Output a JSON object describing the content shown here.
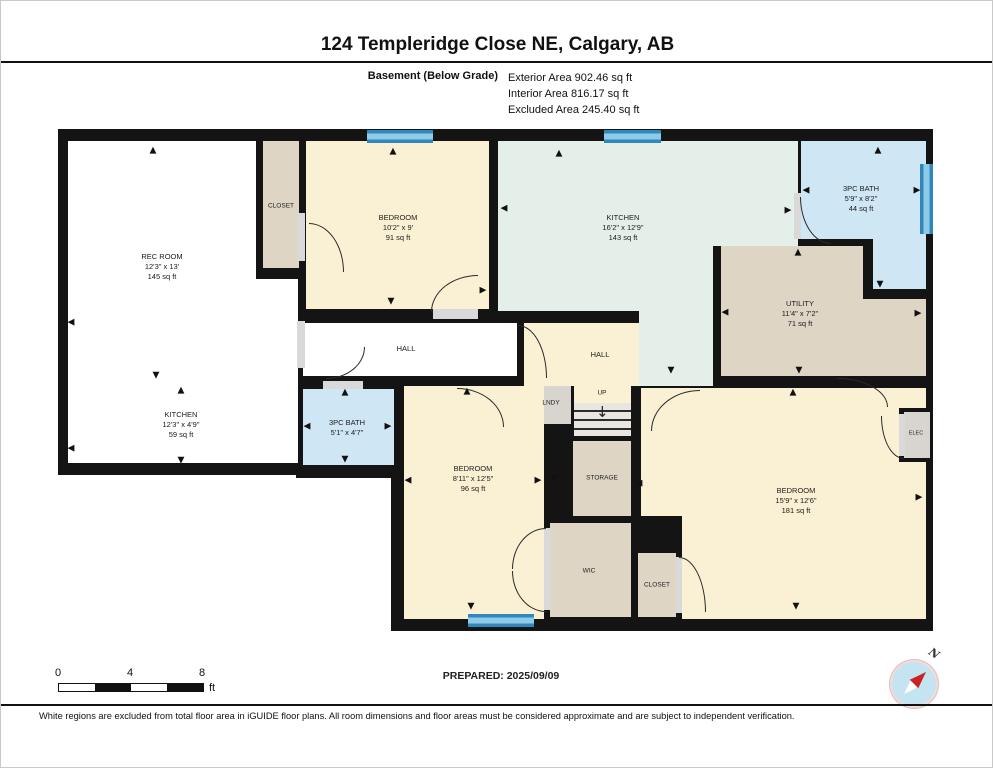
{
  "header": {
    "title": "124 Templeridge Close NE, Calgary, AB",
    "floor_label": "Basement (Below Grade)",
    "areas": {
      "exterior": "Exterior Area 902.46 sq ft",
      "interior": "Interior Area 816.17 sq ft",
      "excluded": "Excluded Area 245.40 sq ft"
    }
  },
  "rooms": {
    "rec_room": {
      "name": "REC ROOM",
      "dims": "12'3\" x 13'",
      "area": "145 sq ft"
    },
    "rec_kitchen": {
      "name": "KITCHEN",
      "dims": "12'3\" x 4'9\"",
      "area": "59 sq ft"
    },
    "closet_top": {
      "name": "CLOSET"
    },
    "bedroom_top": {
      "name": "BEDROOM",
      "dims": "10'2\" x 9'",
      "area": "91 sq ft"
    },
    "kitchen": {
      "name": "KITCHEN",
      "dims": "16'2\" x 12'9\"",
      "area": "143 sq ft"
    },
    "bath_top": {
      "name": "3PC BATH",
      "dims": "5'9\" x 8'2\"",
      "area": "44 sq ft"
    },
    "utility": {
      "name": "UTILITY",
      "dims": "11'4\" x 7'2\"",
      "area": "71 sq ft"
    },
    "hall_main": {
      "name": "HALL"
    },
    "hall_stairs": {
      "name": "HALL"
    },
    "lndy": {
      "name": "LNDY"
    },
    "stairs": {
      "name": "UP"
    },
    "bath_bottom": {
      "name": "3PC BATH",
      "dims": "5'1\" x 4'7\""
    },
    "bedroom_left": {
      "name": "BEDROOM",
      "dims": "8'11\" x 12'5\"",
      "area": "96 sq ft"
    },
    "storage": {
      "name": "STORAGE"
    },
    "wic": {
      "name": "WIC"
    },
    "closet_bottom": {
      "name": "CLOSET"
    },
    "bedroom_right": {
      "name": "BEDROOM",
      "dims": "15'9\" x 12'6\"",
      "area": "181 sq ft"
    },
    "elec": {
      "name": "ELEC"
    }
  },
  "scale_bar": {
    "ticks": [
      "0",
      "4",
      "8"
    ],
    "unit": "ft"
  },
  "footer": {
    "prepared": "PREPARED: 2025/09/09",
    "compass_label": "N",
    "disclaimer": "White regions are excluded from total floor area in iGUIDE floor plans. All room dimensions and floor areas must be considered approximate and are subject to independent verification."
  },
  "colors": {
    "wall": "#141414",
    "room_cream": "#faf1d4",
    "room_sage": "#e5efe9",
    "room_bath_blue": "#cfe6f5",
    "room_tan": "#ded5c5",
    "room_gray": "#d8d5cf",
    "window_dark": "#3187bc",
    "window_light": "#8ecbe8",
    "compass_blue": "#c5e4f2",
    "compass_red": "#cc2222"
  },
  "plan_arrows": [
    [
      "u",
      152,
      150
    ],
    [
      "l",
      70,
      322
    ],
    [
      "d",
      155,
      375
    ],
    [
      "u",
      180,
      390
    ],
    [
      "l",
      70,
      448
    ],
    [
      "d",
      180,
      460
    ],
    [
      "u",
      392,
      151
    ],
    [
      "d",
      390,
      301
    ],
    [
      "r",
      482,
      290
    ],
    [
      "l",
      503,
      208
    ],
    [
      "u",
      558,
      153
    ],
    [
      "r",
      787,
      210
    ],
    [
      "d",
      670,
      370
    ],
    [
      "u",
      877,
      150
    ],
    [
      "l",
      805,
      190
    ],
    [
      "r",
      916,
      190
    ],
    [
      "d",
      879,
      284
    ],
    [
      "u",
      797,
      252
    ],
    [
      "l",
      724,
      312
    ],
    [
      "r",
      917,
      313
    ],
    [
      "d",
      798,
      370
    ],
    [
      "u",
      344,
      392
    ],
    [
      "l",
      306,
      426
    ],
    [
      "r",
      387,
      426
    ],
    [
      "d",
      344,
      459
    ],
    [
      "u",
      466,
      391
    ],
    [
      "l",
      407,
      480
    ],
    [
      "r",
      537,
      480
    ],
    [
      "d",
      470,
      606
    ],
    [
      "r",
      554,
      477
    ],
    [
      "l",
      638,
      483
    ],
    [
      "u",
      792,
      392
    ],
    [
      "r",
      918,
      497
    ],
    [
      "d",
      795,
      606
    ]
  ]
}
